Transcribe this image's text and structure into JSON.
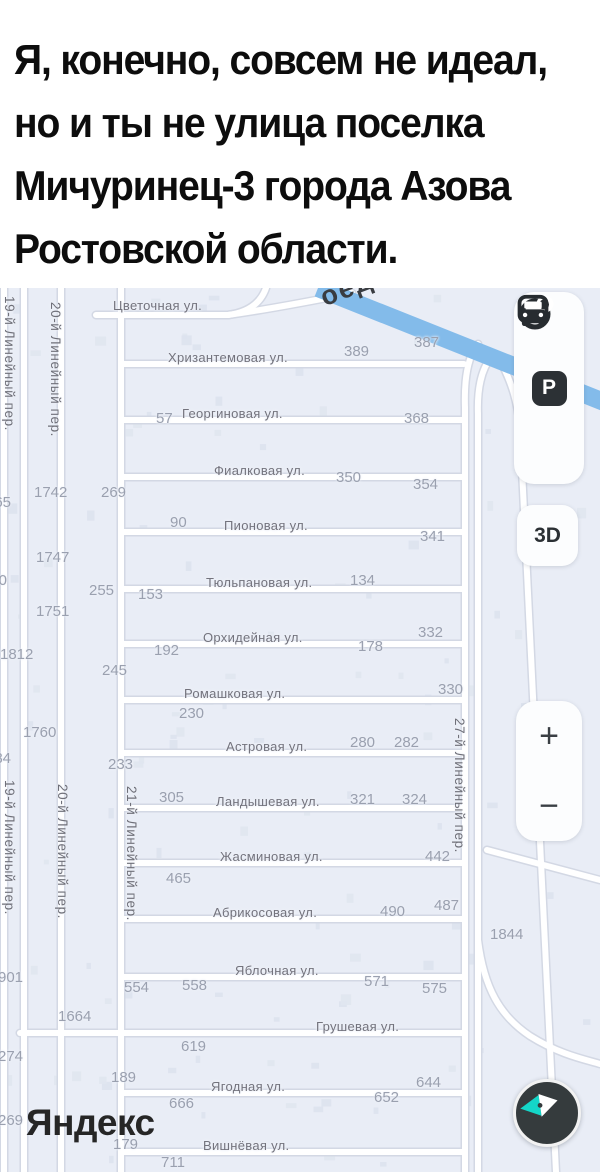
{
  "caption": {
    "lines": [
      "Я, конечно, совсем не идеал,",
      "но и ты не улица поселка",
      "Мичуринец-3 города Азова",
      "Ростовской области."
    ]
  },
  "map": {
    "background": "#e9edf6",
    "highway_color": "#83bbea",
    "logo": "Яндекс",
    "highway_fragment": "оеды",
    "streets": [
      {
        "name": "Цветочная ул.",
        "x": 113,
        "y": 10
      },
      {
        "name": "Хризантемовая ул.",
        "x": 168,
        "y": 62
      },
      {
        "name": "Георгиновая ул.",
        "x": 182,
        "y": 118
      },
      {
        "name": "Фиалковая ул.",
        "x": 214,
        "y": 175
      },
      {
        "name": "Пионовая ул.",
        "x": 224,
        "y": 230
      },
      {
        "name": "Тюльпановая ул.",
        "x": 206,
        "y": 287
      },
      {
        "name": "Орхидейная ул.",
        "x": 203,
        "y": 342
      },
      {
        "name": "Ромашковая ул.",
        "x": 184,
        "y": 398
      },
      {
        "name": "Астровая ул.",
        "x": 226,
        "y": 451
      },
      {
        "name": "Ландышевая ул.",
        "x": 216,
        "y": 506
      },
      {
        "name": "Жасминовая ул.",
        "x": 220,
        "y": 561
      },
      {
        "name": "Абрикосовая ул.",
        "x": 213,
        "y": 617
      },
      {
        "name": "Яблочная ул.",
        "x": 235,
        "y": 675
      },
      {
        "name": "Грушевая ул.",
        "x": 316,
        "y": 731
      },
      {
        "name": "Ягодная ул.",
        "x": 211,
        "y": 791
      },
      {
        "name": "Вишнёвая ул.",
        "x": 203,
        "y": 850
      }
    ],
    "vertical_streets": [
      {
        "name": "19-й Линейный пер.",
        "x": 2,
        "y": 8
      },
      {
        "name": "20-й Линейный пер.",
        "x": 48,
        "y": 14
      },
      {
        "name": "19-й Линейный пер.",
        "x": 2,
        "y": 492
      },
      {
        "name": "20-й Линейный пер.",
        "x": 55,
        "y": 496
      },
      {
        "name": "21-й Линейный пер.",
        "x": 124,
        "y": 498
      },
      {
        "name": "27-й Линейный пер.",
        "x": 452,
        "y": 430
      }
    ],
    "numbers": [
      {
        "t": "389",
        "x": 344,
        "y": 55
      },
      {
        "t": "387",
        "x": 414,
        "y": 46
      },
      {
        "t": "57",
        "x": 156,
        "y": 122
      },
      {
        "t": "368",
        "x": 404,
        "y": 122
      },
      {
        "t": "350",
        "x": 336,
        "y": 181
      },
      {
        "t": "354",
        "x": 413,
        "y": 188
      },
      {
        "t": "269",
        "x": 101,
        "y": 196
      },
      {
        "t": "1742",
        "x": 34,
        "y": 196
      },
      {
        "t": "365",
        "x": -14,
        "y": 206
      },
      {
        "t": "90",
        "x": 170,
        "y": 226
      },
      {
        "t": "341",
        "x": 420,
        "y": 240
      },
      {
        "t": "1747",
        "x": 36,
        "y": 261
      },
      {
        "t": "570",
        "x": -18,
        "y": 284
      },
      {
        "t": "255",
        "x": 89,
        "y": 294
      },
      {
        "t": "153",
        "x": 138,
        "y": 298
      },
      {
        "t": "134",
        "x": 350,
        "y": 284
      },
      {
        "t": "1751",
        "x": 36,
        "y": 315
      },
      {
        "t": "1812",
        "x": 0,
        "y": 358
      },
      {
        "t": "192",
        "x": 154,
        "y": 354
      },
      {
        "t": "178",
        "x": 358,
        "y": 350
      },
      {
        "t": "332",
        "x": 418,
        "y": 336
      },
      {
        "t": "245",
        "x": 102,
        "y": 374
      },
      {
        "t": "330",
        "x": 438,
        "y": 393
      },
      {
        "t": "230",
        "x": 179,
        "y": 417
      },
      {
        "t": "1760",
        "x": 23,
        "y": 436
      },
      {
        "t": "280",
        "x": 350,
        "y": 446
      },
      {
        "t": "282",
        "x": 394,
        "y": 446
      },
      {
        "t": "384",
        "x": -14,
        "y": 462
      },
      {
        "t": "233",
        "x": 108,
        "y": 468
      },
      {
        "t": "305",
        "x": 159,
        "y": 501
      },
      {
        "t": "321",
        "x": 350,
        "y": 503
      },
      {
        "t": "324",
        "x": 402,
        "y": 503
      },
      {
        "t": "442",
        "x": 425,
        "y": 560
      },
      {
        "t": "465",
        "x": 166,
        "y": 582
      },
      {
        "t": "490",
        "x": 380,
        "y": 615
      },
      {
        "t": "487",
        "x": 434,
        "y": 609
      },
      {
        "t": "1844",
        "x": 490,
        "y": 638
      },
      {
        "t": "901",
        "x": -2,
        "y": 681
      },
      {
        "t": "554",
        "x": 124,
        "y": 691
      },
      {
        "t": "558",
        "x": 182,
        "y": 689
      },
      {
        "t": "571",
        "x": 364,
        "y": 685
      },
      {
        "t": "575",
        "x": 422,
        "y": 692
      },
      {
        "t": "1664",
        "x": 58,
        "y": 720
      },
      {
        "t": "619",
        "x": 181,
        "y": 750
      },
      {
        "t": "274",
        "x": -2,
        "y": 760
      },
      {
        "t": "189",
        "x": 111,
        "y": 781
      },
      {
        "t": "666",
        "x": 169,
        "y": 807
      },
      {
        "t": "652",
        "x": 374,
        "y": 801
      },
      {
        "t": "644",
        "x": 416,
        "y": 786
      },
      {
        "t": "269",
        "x": -2,
        "y": 824
      },
      {
        "t": "179",
        "x": 113,
        "y": 848
      },
      {
        "t": "711",
        "x": 161,
        "y": 866
      }
    ],
    "controls": {
      "parking": "P",
      "three_d": "3D",
      "zoom_in": "+",
      "zoom_out": "−",
      "nav_arrow_color": "#14d6c8"
    }
  }
}
